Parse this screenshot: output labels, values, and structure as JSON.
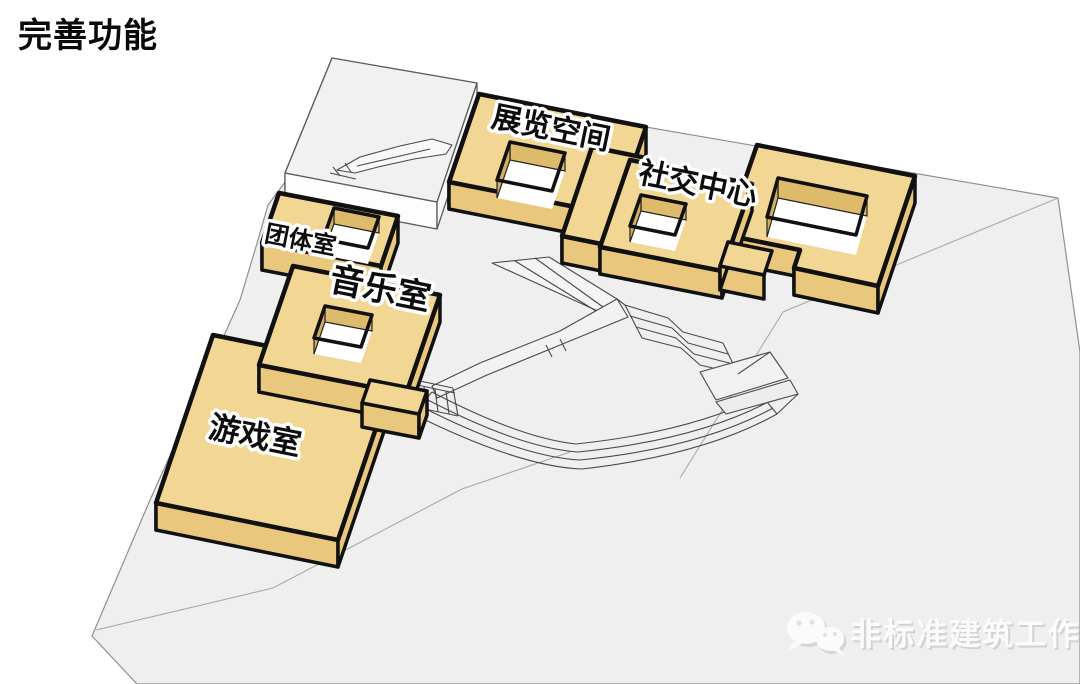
{
  "page": {
    "title": "完善功能",
    "background_color": "#ffffff"
  },
  "diagram": {
    "type": "axonometric-site-diagram",
    "colors": {
      "ground": "#efefef",
      "ground_edge": "#9a9a9a",
      "block_top": "#f1d694",
      "block_side": "#e9c87d",
      "block_inner_wall": "#deba6b",
      "outline": "#111111",
      "wireframe": "#4a4a4a"
    },
    "blocks": {
      "exhibition": {
        "label": "展览空间"
      },
      "social": {
        "label": "社交中心"
      },
      "group": {
        "label": "团体室"
      },
      "music": {
        "label": "音乐室"
      },
      "game": {
        "label": "游戏室"
      }
    }
  },
  "watermark": {
    "text": "非标准建筑工作室",
    "icon": "wechat-icon"
  }
}
